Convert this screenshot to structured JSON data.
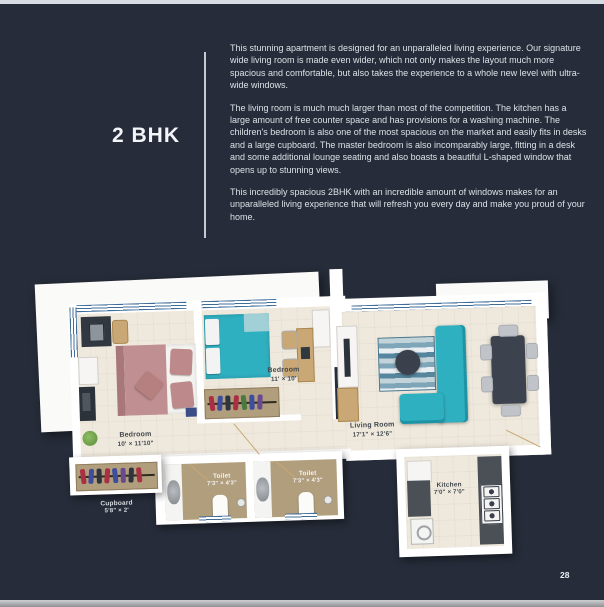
{
  "header": {
    "title": "2 BHK"
  },
  "description": {
    "paragraphs": [
      "This stunning apartment is designed for an unparalleled living experience. Our signature wide living room is made even wider, which not only makes the layout much more spacious and comfortable, but also takes the experience to a whole new level with ultra-wide windows.",
      "The living room is much much larger than most of the competition. The kitchen has a large amount of free counter space and has provisions for a washing machine. The children's bedroom is also one of the most spacious on the market and easily fits in desks and a large cupboard. The master bedroom is also incomparably large, fitting in a desk and some additional lounge seating and also boasts a beautiful L-shaped window that opens up to stunning views.",
      "This incredibly spacious 2BHK with an incredible amount of windows makes for an unparalleled living experience that will refresh you every day and make you proud of your home."
    ]
  },
  "floorplan": {
    "rooms": [
      {
        "name": "Bedroom",
        "dims": "10' × 11'10\""
      },
      {
        "name": "Bedroom",
        "dims": "11' × 10'"
      },
      {
        "name": "Living Room",
        "dims": "17'1\" × 12'6\""
      },
      {
        "name": "Toilet",
        "dims": "7'3\" × 4'3\""
      },
      {
        "name": "Toilet",
        "dims": "7'3\" × 4'3\""
      },
      {
        "name": "Kitchen",
        "dims": "7'0\" × 7'0\""
      },
      {
        "name": "Cupboard",
        "dims": "5'8\" × 2'"
      }
    ],
    "colors": {
      "background": "#262c39",
      "floor": "#efe9dd",
      "wet_floor": "#b19e7d",
      "accent_teal": "#2fb0c1",
      "bed_pink": "#c08f91",
      "window_blue": "#3f6d9a"
    }
  },
  "footer": {
    "page_number": "28"
  }
}
